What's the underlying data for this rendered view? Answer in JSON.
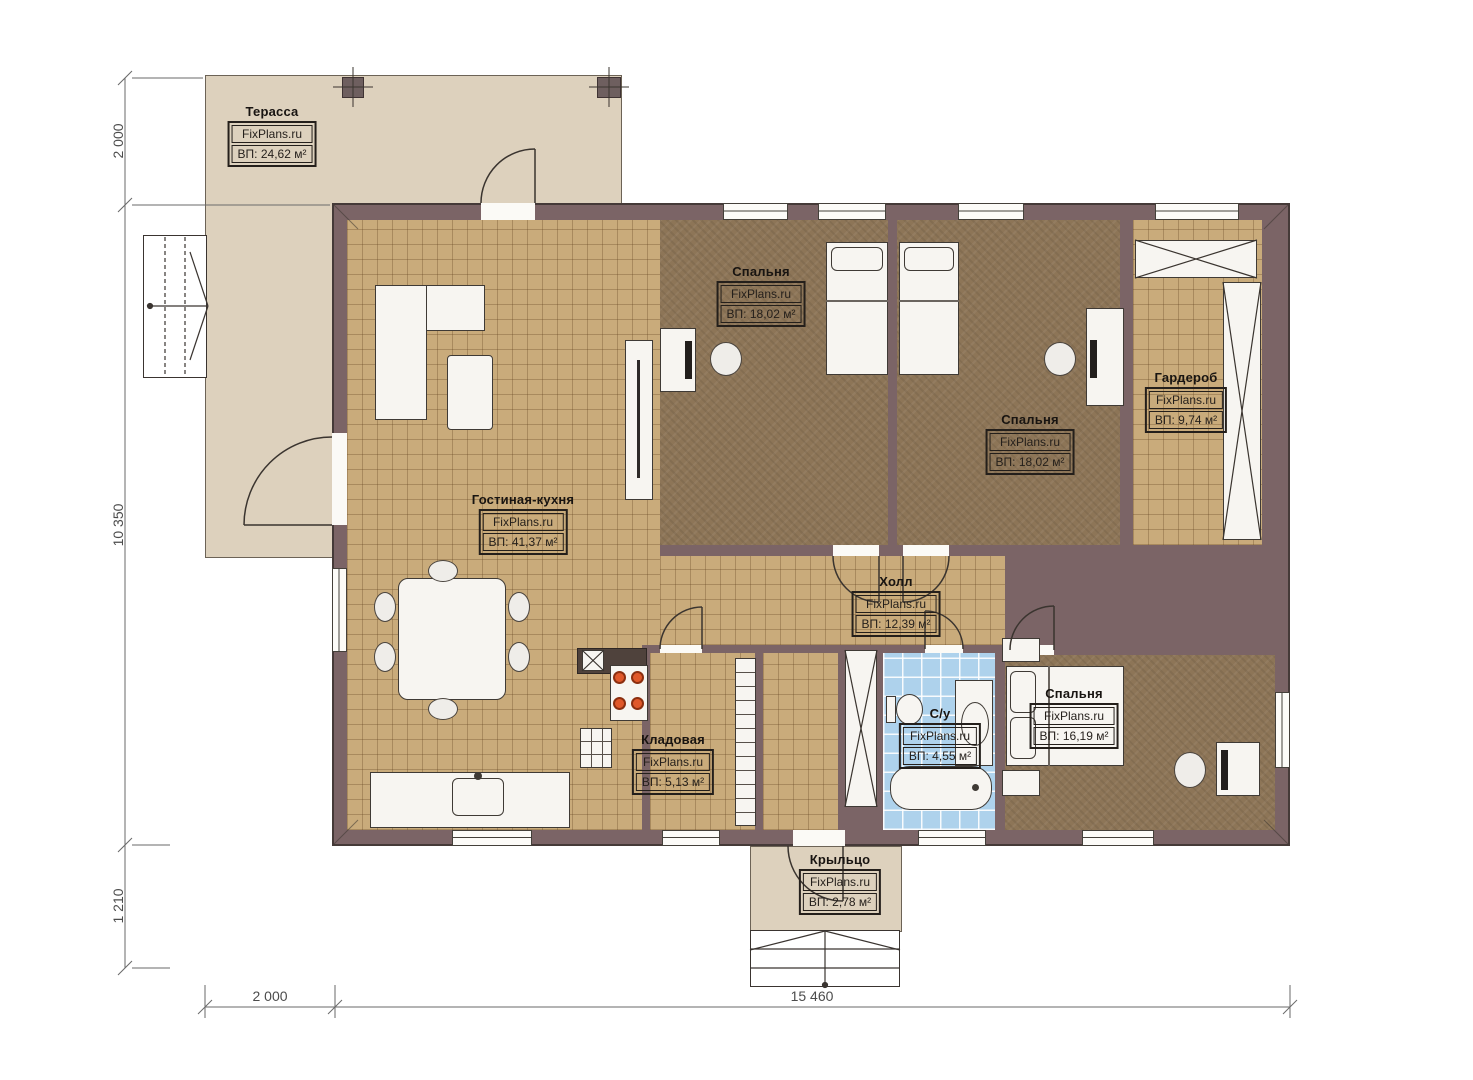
{
  "watermark": "FixPlans.ru",
  "rooms": {
    "terrace": {
      "name": "Терасса",
      "watermark": "FixPlans.ru",
      "area": "ВП: 24,62 м²"
    },
    "living_kitchen": {
      "name": "Гостиная-кухня",
      "watermark": "FixPlans.ru",
      "area": "ВП: 41,37 м²"
    },
    "bedroom1": {
      "name": "Спальня",
      "watermark": "FixPlans.ru",
      "area": "ВП: 18,02 м²"
    },
    "bedroom2": {
      "name": "Спальня",
      "watermark": "FixPlans.ru",
      "area": "ВП: 18,02 м²"
    },
    "wardrobe": {
      "name": "Гардероб",
      "watermark": "FixPlans.ru",
      "area": "ВП: 9,74 м²"
    },
    "hall": {
      "name": "Холл",
      "watermark": "FixPlans.ru",
      "area": "ВП: 12,39 м²"
    },
    "pantry": {
      "name": "Кладовая",
      "watermark": "FixPlans.ru",
      "area": "ВП: 5,13 м²"
    },
    "bathroom": {
      "name": "С/у",
      "watermark": "FixPlans.ru",
      "area": "ВП: 4,55 м²"
    },
    "bedroom3": {
      "name": "Спальня",
      "watermark": "FixPlans.ru",
      "area": "ВП: 16,19 м²"
    },
    "porch": {
      "name": "Крыльцо",
      "watermark": "FixPlans.ru",
      "area": "ВП: 2,78 м²"
    }
  },
  "dimensions": {
    "left_top": "2 000",
    "left_middle": "10 350",
    "left_bottom": "1 210",
    "bottom_left": "2 000",
    "bottom_main": "15 460"
  },
  "colors": {
    "wall": "#7b6466",
    "terrace": "#ddd1bd",
    "tile_floor": "#c9ab7b",
    "bedroom_floor": "#8d7557",
    "bathroom_floor": "#aed2ec",
    "burner": "#e0582a"
  }
}
